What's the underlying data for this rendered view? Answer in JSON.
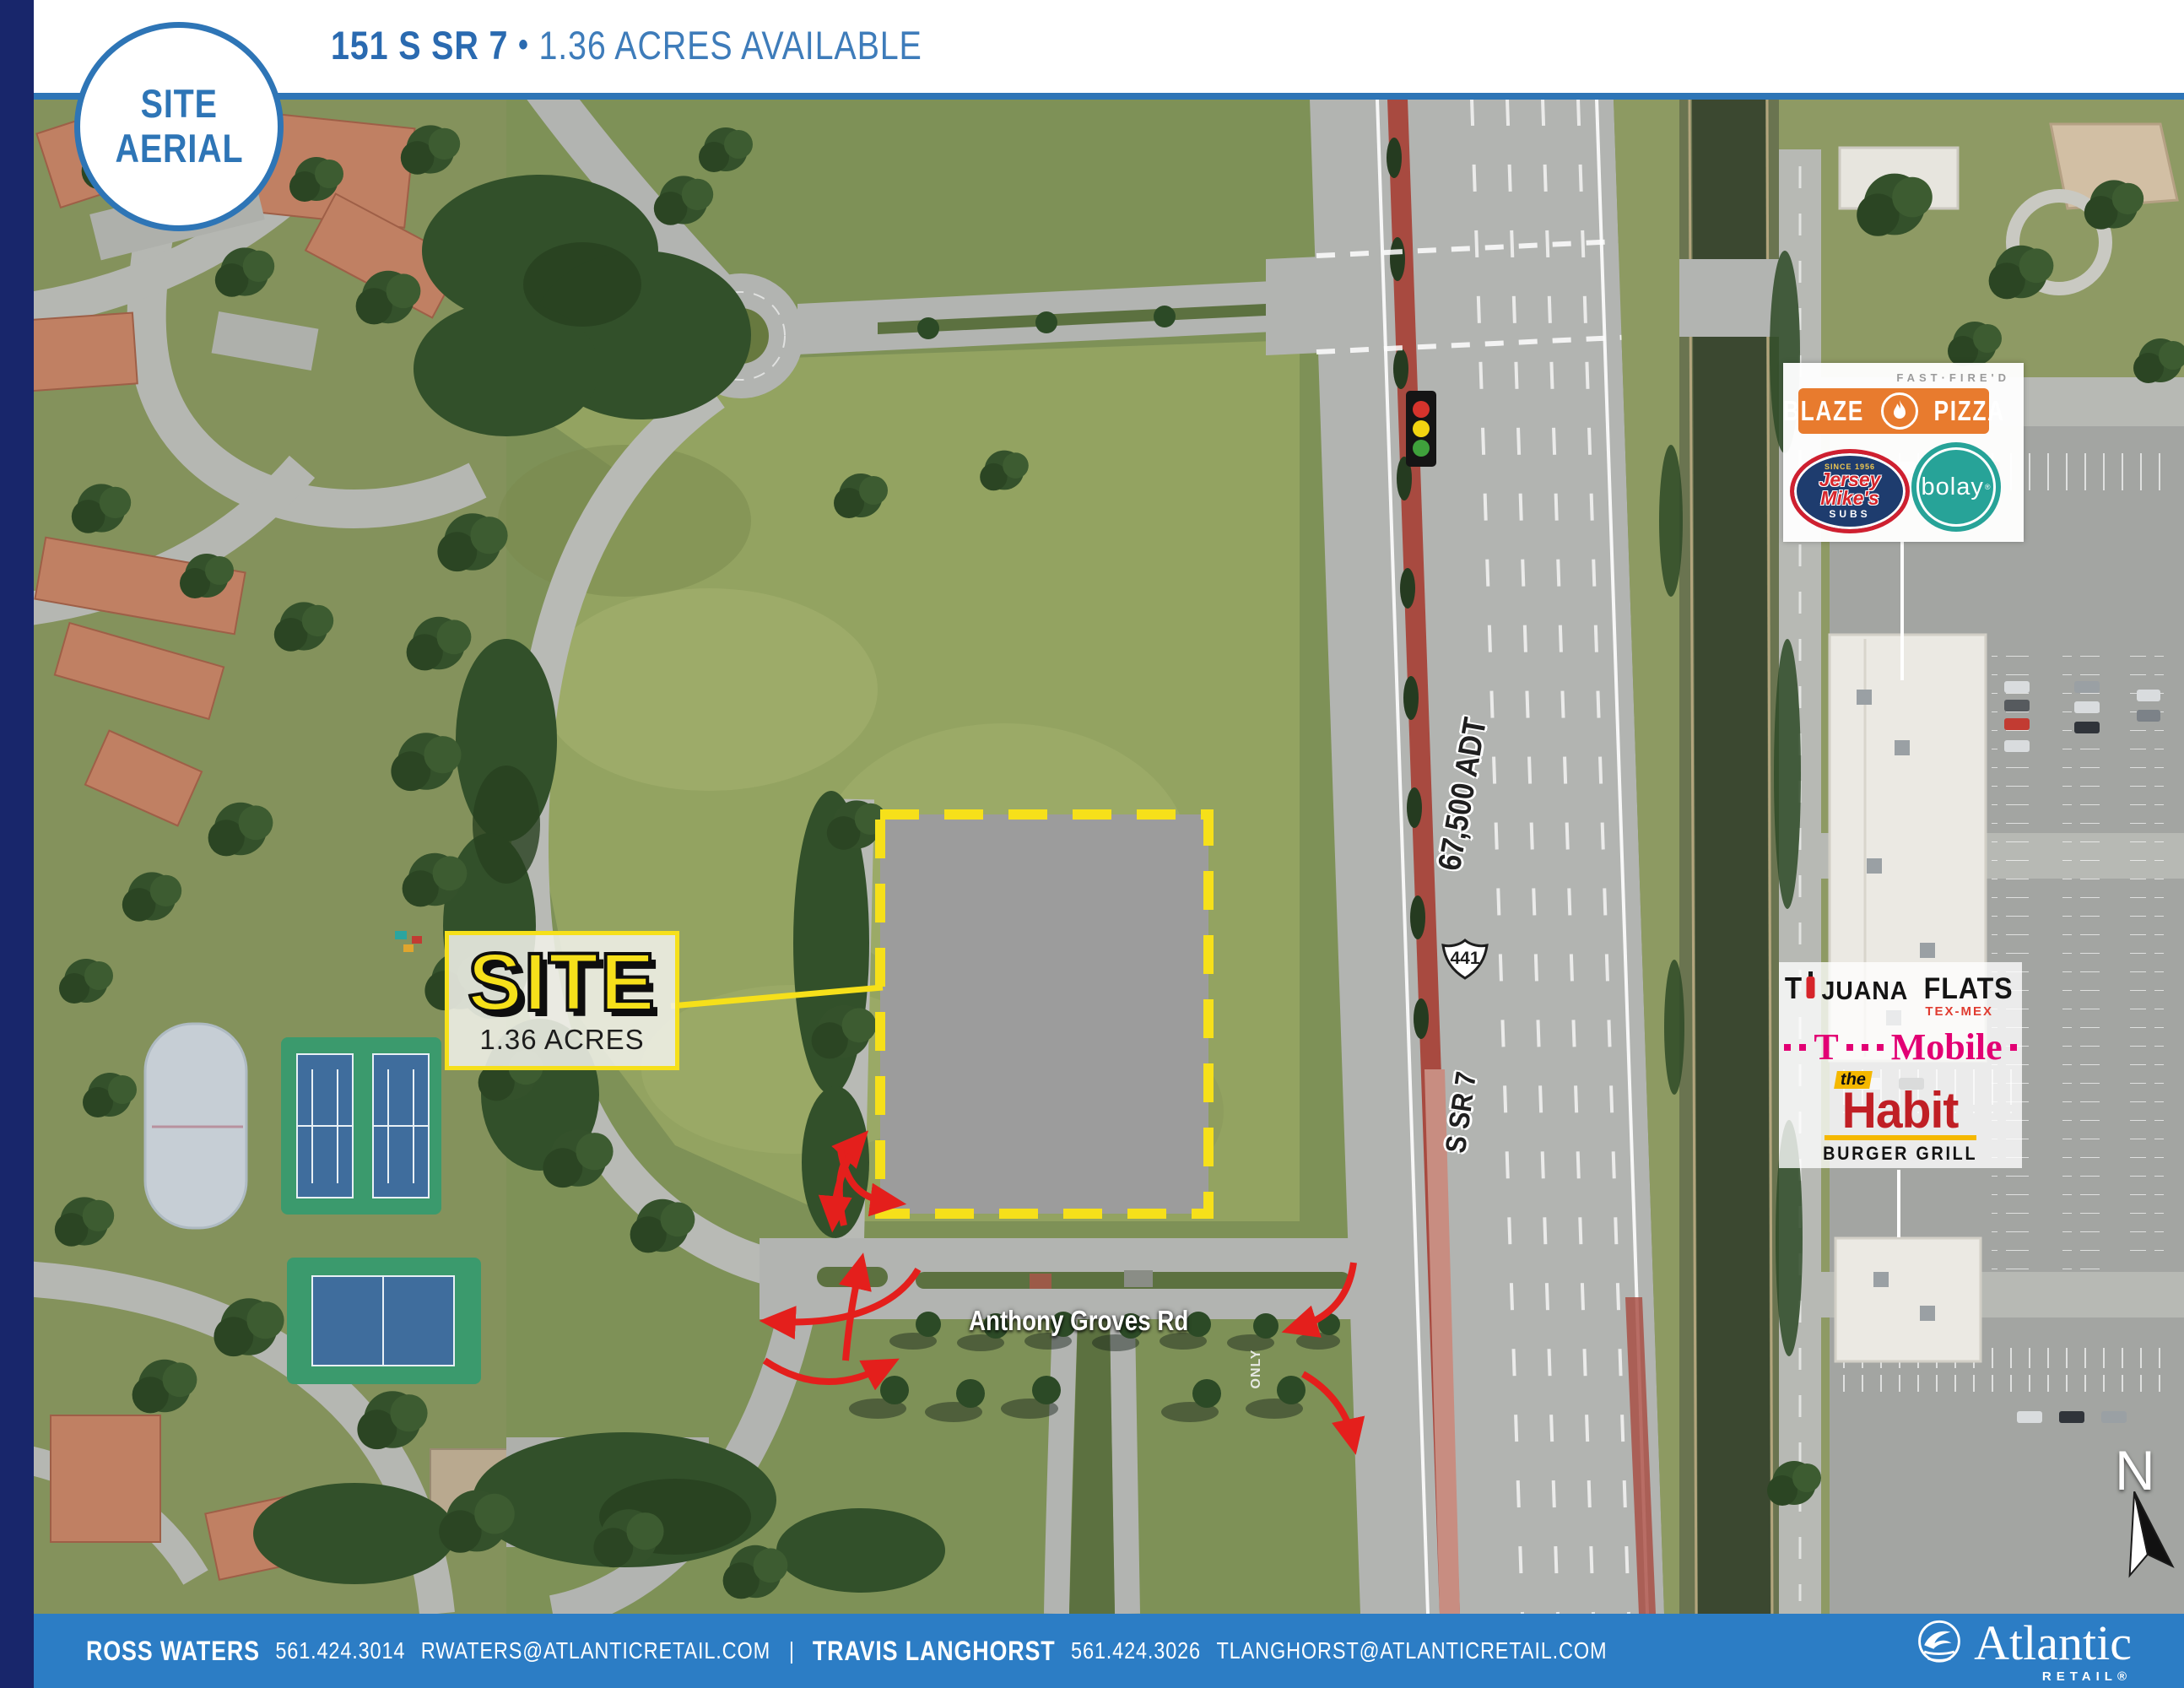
{
  "header": {
    "badge_line1": "SITE",
    "badge_line2": "AERIAL",
    "address": "151 S SR 7",
    "separator": "•",
    "availability": "1.36 ACRES AVAILABLE"
  },
  "site": {
    "label": "SITE",
    "acres": "1.36 ACRES"
  },
  "map": {
    "road": "Anthony Groves Rd",
    "adt": "67,500 ADT",
    "shield": "441",
    "highway": "S SR 7",
    "only": "ONLY",
    "north": "N"
  },
  "tenants": {
    "blaze": {
      "tagline": "FAST·FIRE'D",
      "left": "BLAZE",
      "right": "PIZZA"
    },
    "jersey": {
      "since": "SINCE 1956",
      "line1": "Jersey",
      "line2": "Mike's",
      "subs": "SUBS"
    },
    "bolay": {
      "name": "bolay",
      "reg": "®"
    },
    "tijuana": {
      "t": "T",
      "juana": "JUANA",
      "flats": "FLATS",
      "tagline": "TEX-MEX"
    },
    "tmobile": {
      "t": "T",
      "mobile": "Mobile"
    },
    "habit": {
      "the": "the",
      "name": "Habit",
      "tagline": "BURGER GRILL"
    }
  },
  "footer": {
    "contacts": [
      {
        "name": "ROSS WATERS",
        "phone": "561.424.3014",
        "email": "RWATERS@ATLANTICRETAIL.COM"
      },
      {
        "name": "TRAVIS LANGHORST",
        "phone": "561.424.3026",
        "email": "TLANGHORST@ATLANTICRETAIL.COM"
      }
    ],
    "divider": "|",
    "brand": {
      "name": "Atlantic",
      "sub": "RETAIL®"
    }
  },
  "colors": {
    "accent_blue": "#2e75b6",
    "footer_blue": "#2c7dc5",
    "navy": "#18266b",
    "site_yellow": "#f6e01a",
    "arrow_red": "#e41f1c",
    "tmobile_magenta": "#e20074",
    "habit_red": "#c01f25",
    "blaze_orange": "#e87b2e",
    "bolay_teal": "#27a398"
  }
}
